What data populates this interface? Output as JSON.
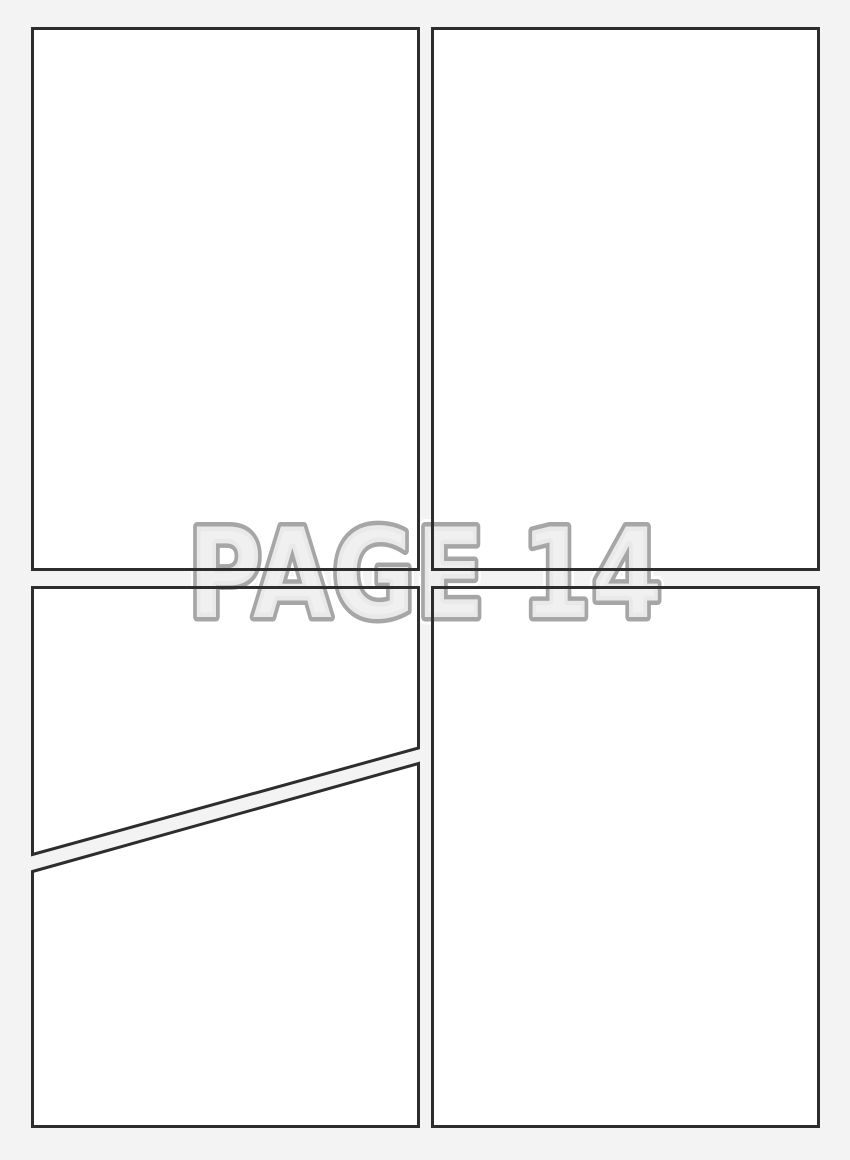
{
  "watermark": {
    "text": "PAGE 14"
  },
  "colors": {
    "page_background": "#f3f3f4",
    "panel_fill": "#ffffff",
    "panel_border": "#2d2d2d",
    "watermark_fill": "#efefef",
    "watermark_outline": "#a6a6a6",
    "watermark_halo": "#ffffff"
  }
}
